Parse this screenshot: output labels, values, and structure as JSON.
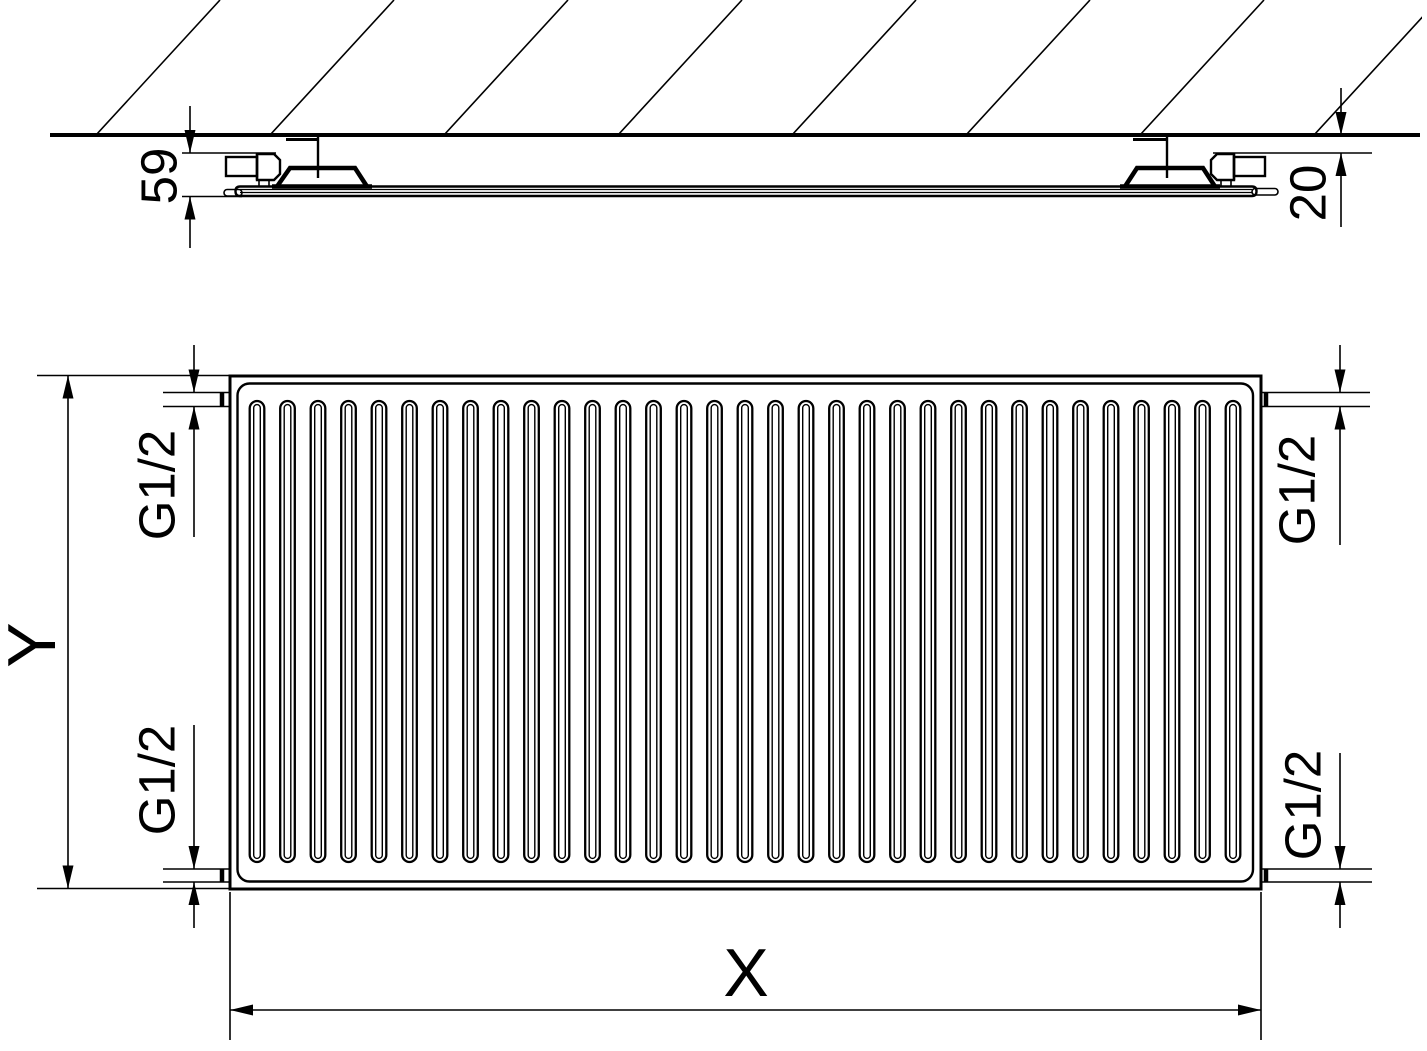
{
  "drawing": {
    "type": "radiator technical drawing",
    "colors": {
      "line": "#000000",
      "background": "#ffffff"
    }
  },
  "top_view": {
    "dim_depth_label": "59",
    "dim_wall_gap_label": "20"
  },
  "front_view": {
    "dim_height_label": "Y",
    "dim_width_label": "X",
    "conn_top_left": "G1/2",
    "conn_bottom_left": "G1/2",
    "conn_top_right": "G1/2",
    "conn_bottom_right": "G1/2",
    "channels": {
      "count": 33,
      "first_center_x": 257,
      "spacing": 30.5,
      "top_y": 401,
      "bottom_y": 862,
      "outer_width": 14.6,
      "inner_width": 6.6,
      "inner_inset": 3.6
    }
  }
}
